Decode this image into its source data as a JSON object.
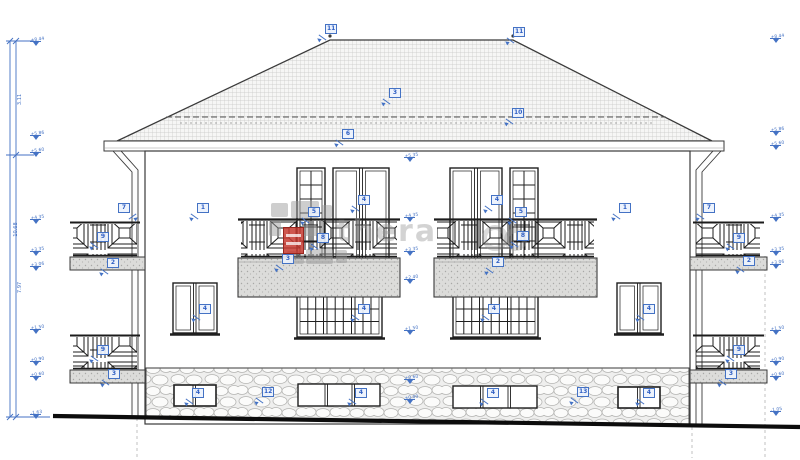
{
  "drawing_type": "building-elevation",
  "colors": {
    "annotation_blue": "#4472c4",
    "line": "#3a3a3a",
    "ground": "#0c0c0c",
    "watermark_red": "#c63a30",
    "watermark_gray": "#989898"
  },
  "watermark": {
    "text": "thera"
  },
  "dimensions": [
    {
      "label": "3.11",
      "x": 13,
      "y": 96
    },
    {
      "label": "10.68",
      "x": 7,
      "y": 226
    },
    {
      "label": "7.97",
      "x": 13,
      "y": 284
    }
  ],
  "levels": [
    {
      "x": 30,
      "y": 41,
      "v": "+8.44"
    },
    {
      "x": 30,
      "y": 135,
      "v": "+5.86"
    },
    {
      "x": 30,
      "y": 152,
      "v": "+5.60"
    },
    {
      "x": 30,
      "y": 219,
      "v": "+4.35"
    },
    {
      "x": 30,
      "y": 251,
      "v": "+3.35"
    },
    {
      "x": 30,
      "y": 266,
      "v": "+3.06"
    },
    {
      "x": 30,
      "y": 329,
      "v": "+1.50"
    },
    {
      "x": 30,
      "y": 361,
      "v": "+0.90"
    },
    {
      "x": 30,
      "y": 376,
      "v": "+0.60"
    },
    {
      "x": 30,
      "y": 414,
      "v": "-1.63"
    },
    {
      "x": 404,
      "y": 157,
      "v": "+5.35"
    },
    {
      "x": 404,
      "y": 217,
      "v": "+4.35"
    },
    {
      "x": 404,
      "y": 251,
      "v": "+3.35"
    },
    {
      "x": 404,
      "y": 279,
      "v": "+2.40"
    },
    {
      "x": 404,
      "y": 330,
      "v": "+1.50"
    },
    {
      "x": 404,
      "y": 379,
      "v": "+0.60"
    },
    {
      "x": 404,
      "y": 399,
      "v": "±0.00"
    },
    {
      "x": 770,
      "y": 38,
      "v": "+8.44"
    },
    {
      "x": 770,
      "y": 131,
      "v": "+5.86"
    },
    {
      "x": 770,
      "y": 145,
      "v": "+5.60"
    },
    {
      "x": 770,
      "y": 217,
      "v": "+4.35"
    },
    {
      "x": 770,
      "y": 251,
      "v": "+3.35"
    },
    {
      "x": 770,
      "y": 264,
      "v": "+3.06"
    },
    {
      "x": 770,
      "y": 330,
      "v": "+1.50"
    },
    {
      "x": 770,
      "y": 361,
      "v": "+0.90"
    },
    {
      "x": 770,
      "y": 376,
      "v": "+0.60"
    },
    {
      "x": 770,
      "y": 411,
      "v": "-1.05"
    }
  ],
  "callouts": [
    {
      "label": "11",
      "x": 325,
      "y": 24,
      "name": "ridge-left"
    },
    {
      "label": "11",
      "x": 513,
      "y": 27,
      "name": "ridge-right"
    },
    {
      "label": "3",
      "x": 389,
      "y": 88,
      "name": "roof-surface"
    },
    {
      "label": "10",
      "x": 512,
      "y": 108,
      "name": "roof-break-line"
    },
    {
      "label": "6",
      "x": 342,
      "y": 129,
      "name": "eaves"
    },
    {
      "label": "7",
      "x": 118,
      "y": 203,
      "dir": "dr",
      "name": "downspout-left"
    },
    {
      "label": "7",
      "x": 703,
      "y": 203,
      "name": "downspout-right"
    },
    {
      "label": "1",
      "x": 197,
      "y": 203,
      "name": "wall-left"
    },
    {
      "label": "1",
      "x": 619,
      "y": 203,
      "name": "wall-right"
    },
    {
      "label": "5",
      "x": 308,
      "y": 207,
      "name": "balcony-door-left"
    },
    {
      "label": "5",
      "x": 515,
      "y": 207,
      "name": "balcony-door-right"
    },
    {
      "label": "4",
      "x": 358,
      "y": 195,
      "name": "ff-window-left"
    },
    {
      "label": "4",
      "x": 491,
      "y": 195,
      "name": "ff-window-right"
    },
    {
      "label": "8",
      "x": 317,
      "y": 233,
      "name": "front-railing-left"
    },
    {
      "label": "8",
      "x": 517,
      "y": 231,
      "name": "front-railing-right"
    },
    {
      "label": "3",
      "x": 282,
      "y": 254,
      "name": "front-slab-left"
    },
    {
      "label": "2",
      "x": 492,
      "y": 257,
      "name": "front-slab-right"
    },
    {
      "label": "9",
      "x": 97,
      "y": 232,
      "name": "side-railing-left-upper"
    },
    {
      "label": "2",
      "x": 107,
      "y": 258,
      "name": "side-slab-left-upper"
    },
    {
      "label": "9",
      "x": 733,
      "y": 233,
      "name": "side-railing-right-upper"
    },
    {
      "label": "2",
      "x": 743,
      "y": 256,
      "name": "side-slab-right-upper"
    },
    {
      "label": "9",
      "x": 97,
      "y": 345,
      "name": "side-railing-left-lower"
    },
    {
      "label": "3",
      "x": 108,
      "y": 369,
      "name": "side-slab-left-lower"
    },
    {
      "label": "9",
      "x": 733,
      "y": 345,
      "name": "side-railing-right-lower"
    },
    {
      "label": "3",
      "x": 725,
      "y": 369,
      "name": "side-slab-right-lower"
    },
    {
      "label": "4",
      "x": 199,
      "y": 304,
      "name": "gf-window-narrow-left"
    },
    {
      "label": "4",
      "x": 358,
      "y": 304,
      "name": "gf-window-large-left"
    },
    {
      "label": "4",
      "x": 488,
      "y": 304,
      "name": "gf-window-large-right"
    },
    {
      "label": "4",
      "x": 643,
      "y": 304,
      "name": "gf-window-narrow-right"
    },
    {
      "label": "4",
      "x": 192,
      "y": 388,
      "name": "bsmt-window-small-left"
    },
    {
      "label": "12",
      "x": 262,
      "y": 387,
      "name": "bsmt-wall-left"
    },
    {
      "label": "4",
      "x": 355,
      "y": 388,
      "name": "bsmt-window-wide-left"
    },
    {
      "label": "4",
      "x": 487,
      "y": 388,
      "name": "bsmt-window-wide-right"
    },
    {
      "label": "13",
      "x": 577,
      "y": 387,
      "name": "bsmt-wall-right"
    },
    {
      "label": "4",
      "x": 643,
      "y": 388,
      "name": "bsmt-window-small-right"
    }
  ]
}
